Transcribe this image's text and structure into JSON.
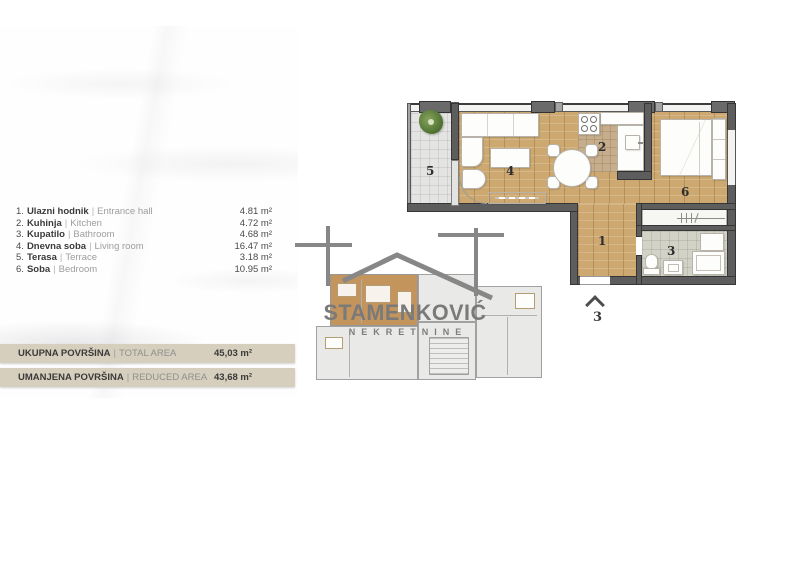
{
  "room_list": {
    "separator": "|",
    "items": [
      {
        "num": "1.",
        "name_sr": "Ulazni hodnik",
        "name_en": "Entrance hall",
        "area": "4.81 m²"
      },
      {
        "num": "2.",
        "name_sr": "Kuhinja",
        "name_en": "Kitchen",
        "area": "4.72 m²"
      },
      {
        "num": "3.",
        "name_sr": "Kupatilo",
        "name_en": "Bathroom",
        "area": "4.68 m²"
      },
      {
        "num": "4.",
        "name_sr": "Dnevna soba",
        "name_en": "Living room",
        "area": "16.47 m²"
      },
      {
        "num": "5.",
        "name_sr": "Terasa",
        "name_en": "Terrace",
        "area": "3.18 m²"
      },
      {
        "num": "6.",
        "name_sr": "Soba",
        "name_en": "Bedroom",
        "area": "10.95 m²"
      }
    ]
  },
  "totals": {
    "separator": "|",
    "rows": [
      {
        "label_sr": "UKUPNA POVRŠINA",
        "label_en": "TOTAL AREA",
        "value": "45,03 m²"
      },
      {
        "label_sr": "UMANJENA POVRŠINA",
        "label_en": "REDUCED AREA",
        "value": "43,68 m²"
      }
    ]
  },
  "floor_plan": {
    "labels": {
      "hall": "1",
      "kitchen": "2",
      "bathroom": "3",
      "living": "4",
      "terrace": "5",
      "bedroom": "6"
    },
    "entrance_label": "3"
  },
  "logo": {
    "brand": "STAMENKOVIĆ",
    "subtitle": "NEKRETNINE"
  },
  "colors": {
    "bar_background": "#d7cfbd",
    "wood_floor": "#cda971",
    "kitchen_tile": "#c6ad8c",
    "bath_tile": "#d2d3c6",
    "wall": "#5d5d5d",
    "highlighted_unit": "#bf8c50",
    "logo_gray": "#7a7a7a"
  }
}
